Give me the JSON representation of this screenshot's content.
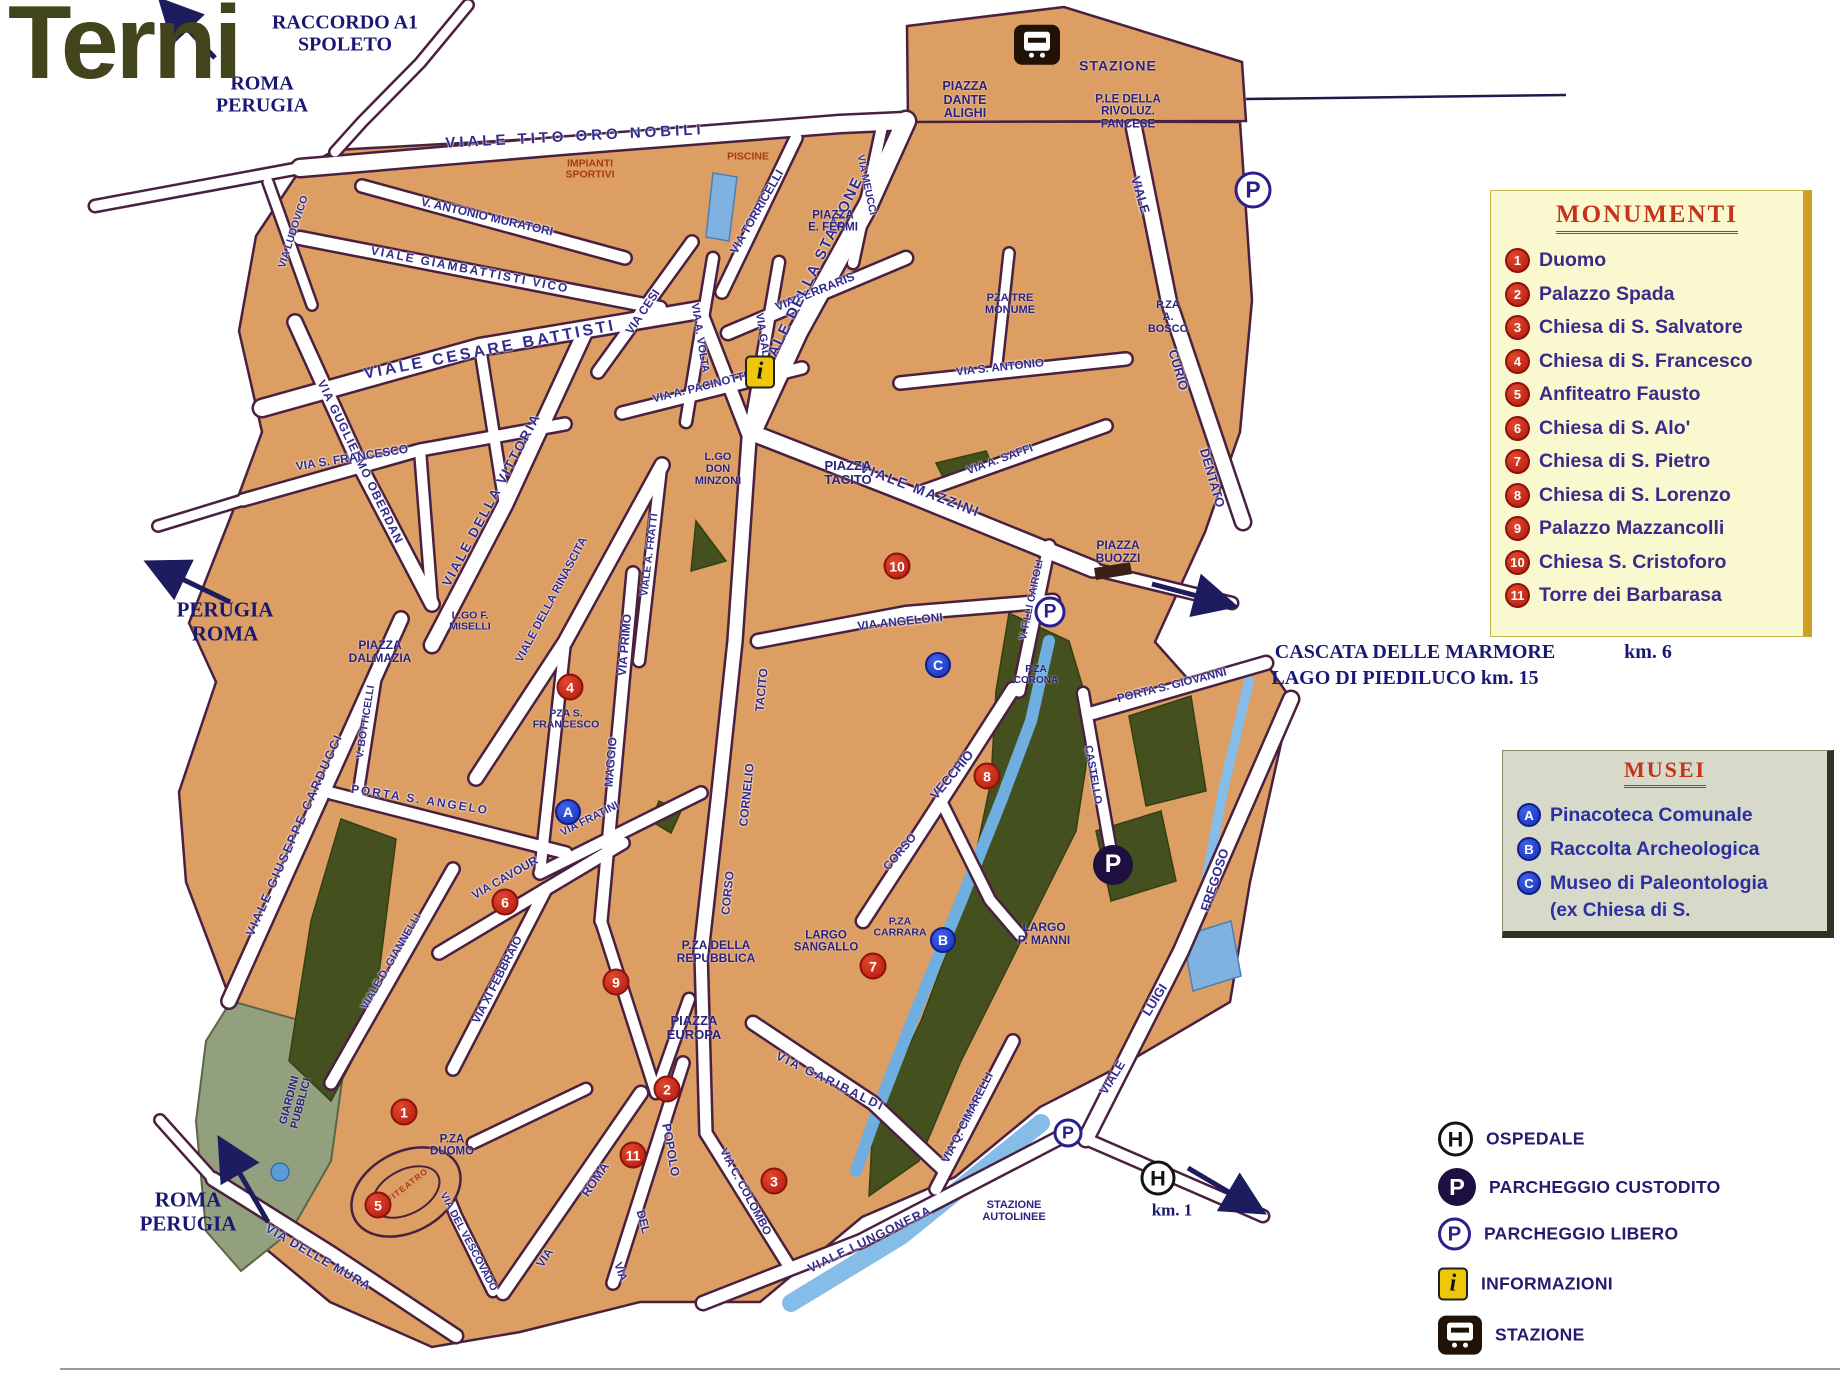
{
  "title": "Terni",
  "map": {
    "colors": {
      "block_fill": "#DC9E62",
      "block_edge": "#4A2040",
      "street": "#FFFFFF",
      "park_dark": "#44511E",
      "park_gray": "#93A07E",
      "river": "#6FAEE0",
      "navy_label": "#332A8E",
      "red_label": "#A93A16",
      "serif_label": "#191974",
      "marker_red": "#B2190E",
      "marker_blue": "#1630B8",
      "title_olive": "#42451B"
    },
    "labels": [
      {
        "t": "RACCORDO A1\nSPOLETO",
        "x": 345,
        "y": 34,
        "r": 0,
        "k": "hw",
        "s": 20
      },
      {
        "t": "ROMA\nPERUGIA",
        "x": 262,
        "y": 95,
        "r": 0,
        "k": "hw",
        "s": 20
      },
      {
        "t": "PERUGIA\nROMA",
        "x": 225,
        "y": 622,
        "r": 0,
        "k": "hw",
        "s": 21
      },
      {
        "t": "ROMA\nPERUGIA",
        "x": 188,
        "y": 1212,
        "r": 0,
        "k": "hw",
        "s": 21
      },
      {
        "t": "CASCATA DELLE MARMORE",
        "x": 1415,
        "y": 652,
        "r": 0,
        "k": "hw",
        "s": 20
      },
      {
        "t": "km. 6",
        "x": 1648,
        "y": 652,
        "r": 0,
        "k": "hw",
        "s": 20
      },
      {
        "t": "LAGO DI PIEDILUCO  km. 15",
        "x": 1405,
        "y": 678,
        "r": 0,
        "k": "hw",
        "s": 20
      },
      {
        "t": "km. 1",
        "x": 1172,
        "y": 1210,
        "r": 0,
        "k": "hw",
        "s": 17
      },
      {
        "t": "VIALE  TITO  ORO  NOBILI",
        "x": 575,
        "y": 137,
        "r": -3,
        "k": "st",
        "s": 15,
        "ls": 4
      },
      {
        "t": "V. ANTONIO  MURATORI",
        "x": 487,
        "y": 217,
        "r": 13,
        "k": "st",
        "s": 12
      },
      {
        "t": "VIALE  GIAMBATTISTI  VICO",
        "x": 470,
        "y": 270,
        "r": 11,
        "k": "st",
        "s": 12,
        "ls": 2
      },
      {
        "t": "VIA LUDOVICO",
        "x": 294,
        "y": 232,
        "r": -72,
        "k": "st",
        "s": 10.5
      },
      {
        "t": "VIA GUGLIELMO OBERDAN",
        "x": 360,
        "y": 462,
        "r": 64,
        "k": "st",
        "s": 12,
        "ls": 1
      },
      {
        "t": "VIALE  CESARE  BATTISTI",
        "x": 490,
        "y": 350,
        "r": -11,
        "k": "st",
        "s": 16,
        "ls": 3
      },
      {
        "t": "VIA S. FRANCESCO",
        "x": 352,
        "y": 458,
        "r": -9,
        "k": "st",
        "s": 12
      },
      {
        "t": "VIALE DELLA VITTORIA",
        "x": 492,
        "y": 500,
        "r": -62,
        "k": "st",
        "s": 13.5,
        "ls": 2
      },
      {
        "t": "VIALE DELLA RINASCITA",
        "x": 552,
        "y": 600,
        "r": -62,
        "k": "st",
        "s": 11.5
      },
      {
        "t": "VIA CESI",
        "x": 643,
        "y": 312,
        "r": -56,
        "k": "st",
        "s": 12
      },
      {
        "t": "VIA A. VOLTA",
        "x": 699,
        "y": 338,
        "r": 81,
        "k": "st",
        "s": 11
      },
      {
        "t": "VIA GALILEI",
        "x": 763,
        "y": 345,
        "r": 81,
        "k": "st",
        "s": 11
      },
      {
        "t": "VIA  FERRARIS",
        "x": 815,
        "y": 292,
        "r": -22,
        "k": "st",
        "s": 12
      },
      {
        "t": "VIA TORRICELLI",
        "x": 757,
        "y": 212,
        "r": -60,
        "k": "st",
        "s": 12
      },
      {
        "t": "VIA MEUCCI",
        "x": 866,
        "y": 185,
        "r": 78,
        "k": "st",
        "s": 10.5
      },
      {
        "t": "VIALE DELLA STAZIONE",
        "x": 812,
        "y": 275,
        "r": -64,
        "k": "st",
        "s": 15,
        "ls": 2
      },
      {
        "t": "VIA A. PACINOTTI",
        "x": 700,
        "y": 388,
        "r": -14,
        "k": "st",
        "s": 11.5
      },
      {
        "t": "VIA  S.  ANTONIO",
        "x": 1000,
        "y": 368,
        "r": -6,
        "k": "st",
        "s": 11.5
      },
      {
        "t": "VIA A. SAFFI",
        "x": 1000,
        "y": 460,
        "r": -20,
        "k": "st",
        "s": 11.5
      },
      {
        "t": "VIALE  MAZZINI",
        "x": 920,
        "y": 490,
        "r": 21,
        "k": "st",
        "s": 14,
        "ls": 2
      },
      {
        "t": "VIALE",
        "x": 1140,
        "y": 195,
        "r": 74,
        "k": "st",
        "s": 13
      },
      {
        "t": "CURIO",
        "x": 1178,
        "y": 370,
        "r": 74,
        "k": "st",
        "s": 13
      },
      {
        "t": "DENTATO",
        "x": 1212,
        "y": 478,
        "r": 74,
        "k": "st",
        "s": 13
      },
      {
        "t": "VIA  ANGELONI",
        "x": 900,
        "y": 622,
        "r": -6,
        "k": "st",
        "s": 12
      },
      {
        "t": "V. F.LLI CAIROLI",
        "x": 1032,
        "y": 600,
        "r": -78,
        "k": "st",
        "s": 10.5
      },
      {
        "t": "TACITO",
        "x": 762,
        "y": 690,
        "r": -84,
        "k": "st",
        "s": 12
      },
      {
        "t": "CORNELIO",
        "x": 747,
        "y": 795,
        "r": -84,
        "k": "st",
        "s": 12
      },
      {
        "t": "CORSO",
        "x": 728,
        "y": 893,
        "r": -84,
        "k": "st",
        "s": 12
      },
      {
        "t": "VIA PRIMO",
        "x": 625,
        "y": 645,
        "r": -85,
        "k": "st",
        "s": 12
      },
      {
        "t": "MAGGIO",
        "x": 611,
        "y": 762,
        "r": -85,
        "k": "st",
        "s": 12
      },
      {
        "t": "VIALE A. FRATTI",
        "x": 650,
        "y": 555,
        "r": -83,
        "k": "st",
        "s": 10.5
      },
      {
        "t": "VECCHIO",
        "x": 952,
        "y": 775,
        "r": -50,
        "k": "st",
        "s": 13
      },
      {
        "t": "CORSO",
        "x": 900,
        "y": 852,
        "r": -50,
        "k": "st",
        "s": 12
      },
      {
        "t": "CASTELLO",
        "x": 1092,
        "y": 775,
        "r": 80,
        "k": "st",
        "s": 11
      },
      {
        "t": "PORTA S. GIOVANNI",
        "x": 1172,
        "y": 686,
        "r": -14,
        "k": "st",
        "s": 11.5
      },
      {
        "t": "VIA FRATINI",
        "x": 590,
        "y": 820,
        "r": -27,
        "k": "st",
        "s": 11
      },
      {
        "t": "VIA CAVOUR",
        "x": 505,
        "y": 878,
        "r": -30,
        "k": "st",
        "s": 12
      },
      {
        "t": "VIA XI FEBBRAIO",
        "x": 498,
        "y": 980,
        "r": -63,
        "k": "st",
        "s": 11.5
      },
      {
        "t": "VIALE D. GIANNELLI",
        "x": 392,
        "y": 962,
        "r": -60,
        "k": "st",
        "s": 11
      },
      {
        "t": "VIALE  GIUSEPPE  CARDUCCI",
        "x": 295,
        "y": 835,
        "r": -66,
        "k": "st",
        "s": 12.5,
        "ls": 2
      },
      {
        "t": "PORTA  S.  ANGELO",
        "x": 420,
        "y": 800,
        "r": 9,
        "k": "st",
        "s": 12,
        "ls": 2
      },
      {
        "t": "V. BOTTICELLI",
        "x": 366,
        "y": 722,
        "r": -81,
        "k": "st",
        "s": 10.5
      },
      {
        "t": "ROMA",
        "x": 596,
        "y": 1180,
        "r": -56,
        "k": "st",
        "s": 12.5
      },
      {
        "t": "VIA",
        "x": 545,
        "y": 1258,
        "r": -56,
        "k": "st",
        "s": 12
      },
      {
        "t": "VIA",
        "x": 620,
        "y": 1272,
        "r": 70,
        "k": "st",
        "s": 11.5
      },
      {
        "t": "DEL",
        "x": 643,
        "y": 1222,
        "r": 75,
        "k": "st",
        "s": 12
      },
      {
        "t": "POPOLO",
        "x": 670,
        "y": 1150,
        "r": 80,
        "k": "st",
        "s": 12.5
      },
      {
        "t": "VIA C. COLOMBO",
        "x": 745,
        "y": 1192,
        "r": 62,
        "k": "st",
        "s": 11.5
      },
      {
        "t": "VIA  GARIBALDI",
        "x": 830,
        "y": 1082,
        "r": 26,
        "k": "st",
        "s": 12.5,
        "ls": 2
      },
      {
        "t": "VIALE LUNGONERA",
        "x": 870,
        "y": 1240,
        "r": -26,
        "k": "st",
        "s": 12.5,
        "ls": 1
      },
      {
        "t": "VIA Q. CIMARELLI",
        "x": 968,
        "y": 1118,
        "r": -63,
        "k": "st",
        "s": 11.5
      },
      {
        "t": "VIALE",
        "x": 1113,
        "y": 1078,
        "r": -58,
        "k": "st",
        "s": 12.5
      },
      {
        "t": "LUIGI",
        "x": 1155,
        "y": 1000,
        "r": -58,
        "k": "st",
        "s": 13
      },
      {
        "t": "FREGOSO",
        "x": 1215,
        "y": 880,
        "r": -72,
        "k": "st",
        "s": 13
      },
      {
        "t": "VIA DELLE MURA",
        "x": 318,
        "y": 1258,
        "r": 30,
        "k": "st",
        "s": 12.5,
        "ls": 1
      },
      {
        "t": "VIA DEL VESCOVADO",
        "x": 468,
        "y": 1242,
        "r": 62,
        "k": "st",
        "s": 10.5
      },
      {
        "t": "PIAZZA\nDANTE\nALIGHI",
        "x": 965,
        "y": 100,
        "r": 0,
        "k": "pz",
        "s": 12.5
      },
      {
        "t": "P.LE DELLA\nRIVOLUZ.\nFANCESE",
        "x": 1128,
        "y": 112,
        "r": 0,
        "k": "pz",
        "s": 11.5
      },
      {
        "t": "STAZIONE",
        "x": 1118,
        "y": 66,
        "r": 0,
        "k": "pz",
        "s": 14,
        "ls": 1
      },
      {
        "t": "PISCINE",
        "x": 748,
        "y": 157,
        "r": 0,
        "k": "rd",
        "s": 10.5
      },
      {
        "t": "IMPIANTI\nSPORTIVI",
        "x": 590,
        "y": 170,
        "r": 0,
        "k": "rd",
        "s": 10.5
      },
      {
        "t": "PIAZZA\nE. FERMI",
        "x": 833,
        "y": 222,
        "r": 0,
        "k": "pz",
        "s": 11.5
      },
      {
        "t": "PZA TRE\nMONUME",
        "x": 1010,
        "y": 305,
        "r": 0,
        "k": "pz",
        "s": 11
      },
      {
        "t": "P.ZA\nA.\nBOSCO",
        "x": 1168,
        "y": 318,
        "r": 0,
        "k": "pz",
        "s": 11
      },
      {
        "t": "L.GO\nDON\nMINZONI",
        "x": 718,
        "y": 470,
        "r": 0,
        "k": "pz",
        "s": 11
      },
      {
        "t": "PIAZZA\nTACITO",
        "x": 848,
        "y": 473,
        "r": 0,
        "k": "pz",
        "s": 13
      },
      {
        "t": "PIAZZA\nBUOZZI",
        "x": 1118,
        "y": 552,
        "r": 0,
        "k": "pz",
        "s": 12
      },
      {
        "t": "P.ZA\nCORONA",
        "x": 1036,
        "y": 676,
        "r": 0,
        "k": "pz",
        "s": 10
      },
      {
        "t": "PIAZZA\nDALMAZIA",
        "x": 380,
        "y": 652,
        "r": 0,
        "k": "pz",
        "s": 12
      },
      {
        "t": "L.GO F.\nMISELLI",
        "x": 470,
        "y": 622,
        "r": 0,
        "k": "pz",
        "s": 10.5
      },
      {
        "t": "PZA S.\nFRANCESCO",
        "x": 566,
        "y": 720,
        "r": 0,
        "k": "pz",
        "s": 10.5
      },
      {
        "t": "P.ZA DELLA\nREPUBBLICA",
        "x": 716,
        "y": 952,
        "r": 0,
        "k": "pz",
        "s": 12
      },
      {
        "t": "LARGO\nSANGALLO",
        "x": 826,
        "y": 942,
        "r": 0,
        "k": "pz",
        "s": 11.5
      },
      {
        "t": "P.ZA\nCARRARA",
        "x": 900,
        "y": 928,
        "r": 0,
        "k": "pz",
        "s": 10.5
      },
      {
        "t": "LARGO\nP. MANNI",
        "x": 1044,
        "y": 934,
        "r": 0,
        "k": "pz",
        "s": 12
      },
      {
        "t": "PIAZZA\nEUROPA",
        "x": 694,
        "y": 1028,
        "r": 0,
        "k": "pz",
        "s": 13
      },
      {
        "t": "P.ZA\nDUOMO",
        "x": 452,
        "y": 1146,
        "r": 0,
        "k": "pz",
        "s": 11.5
      },
      {
        "t": "STAZIONE\nAUTOLINEE",
        "x": 1014,
        "y": 1212,
        "r": 0,
        "k": "pz",
        "s": 11
      },
      {
        "t": "GIARDINI\nPUBBLICI",
        "x": 296,
        "y": 1102,
        "r": -75,
        "k": "pz",
        "s": 11
      },
      {
        "t": "ANFITEATRO",
        "x": 402,
        "y": 1190,
        "r": -38,
        "k": "rd",
        "s": 8.5,
        "ls": 1
      }
    ],
    "monument_markers": [
      {
        "num": "1",
        "x": 404,
        "y": 1112
      },
      {
        "num": "2",
        "x": 667,
        "y": 1089
      },
      {
        "num": "3",
        "x": 774,
        "y": 1181
      },
      {
        "num": "4",
        "x": 570,
        "y": 687
      },
      {
        "num": "5",
        "x": 378,
        "y": 1205
      },
      {
        "num": "6",
        "x": 505,
        "y": 902
      },
      {
        "num": "7",
        "x": 873,
        "y": 966
      },
      {
        "num": "8",
        "x": 987,
        "y": 776
      },
      {
        "num": "9",
        "x": 616,
        "y": 982
      },
      {
        "num": "10",
        "x": 897,
        "y": 566
      },
      {
        "num": "11",
        "x": 633,
        "y": 1155
      }
    ],
    "museum_markers": [
      {
        "letter": "A",
        "x": 568,
        "y": 812
      },
      {
        "letter": "B",
        "x": 943,
        "y": 940
      },
      {
        "letter": "C",
        "x": 938,
        "y": 665
      }
    ],
    "parking_free": [
      {
        "x": 1050,
        "y": 612,
        "size": 31
      },
      {
        "x": 1253,
        "y": 190,
        "size": 37
      },
      {
        "x": 1068,
        "y": 1133,
        "size": 29
      }
    ],
    "parking_guarded": [
      {
        "x": 1113,
        "y": 865,
        "size": 40
      }
    ],
    "hospital_markers": [
      {
        "x": 1158,
        "y": 1178,
        "size": 35
      }
    ],
    "info_markers": [
      {
        "x": 760,
        "y": 372,
        "size": 30
      }
    ],
    "station_markers": [
      {
        "x": 1037,
        "y": 45,
        "size": 46
      }
    ]
  },
  "legend_monumenti": {
    "title": "MONUMENTI",
    "items": [
      {
        "num": "1",
        "label": "Duomo"
      },
      {
        "num": "2",
        "label": "Palazzo Spada"
      },
      {
        "num": "3",
        "label": "Chiesa di S. Salvatore"
      },
      {
        "num": "4",
        "label": "Chiesa di S. Francesco"
      },
      {
        "num": "5",
        "label": "Anfiteatro Fausto"
      },
      {
        "num": "6",
        "label": "Chiesa di S. Alo'"
      },
      {
        "num": "7",
        "label": "Chiesa di S. Pietro"
      },
      {
        "num": "8",
        "label": "Chiesa di S. Lorenzo"
      },
      {
        "num": "9",
        "label": "Palazzo Mazzancolli"
      },
      {
        "num": "10",
        "label": "Chiesa S. Cristoforo"
      },
      {
        "num": "11",
        "label": "Torre dei Barbarasa"
      }
    ]
  },
  "legend_musei": {
    "title": "MUSEI",
    "items": [
      {
        "letter": "A",
        "label": "Pinacoteca Comunale"
      },
      {
        "letter": "B",
        "label": "Raccolta Archeologica"
      },
      {
        "letter": "C",
        "label": "Museo di Paleontologia"
      }
    ],
    "note": "(ex Chiesa di S."
  },
  "legend_symbols": {
    "items": [
      {
        "icon": "hospital-icon",
        "label": "OSPEDALE",
        "y": 1139
      },
      {
        "icon": "guarded-parking-icon",
        "label": "PARCHEGGIO CUSTODITO",
        "y": 1187
      },
      {
        "icon": "free-parking-icon",
        "label": "PARCHEGGIO LIBERO",
        "y": 1234
      },
      {
        "icon": "information-icon",
        "label": "INFORMAZIONI",
        "y": 1284
      },
      {
        "icon": "train-station-icon",
        "label": "STAZIONE",
        "y": 1335
      }
    ]
  }
}
